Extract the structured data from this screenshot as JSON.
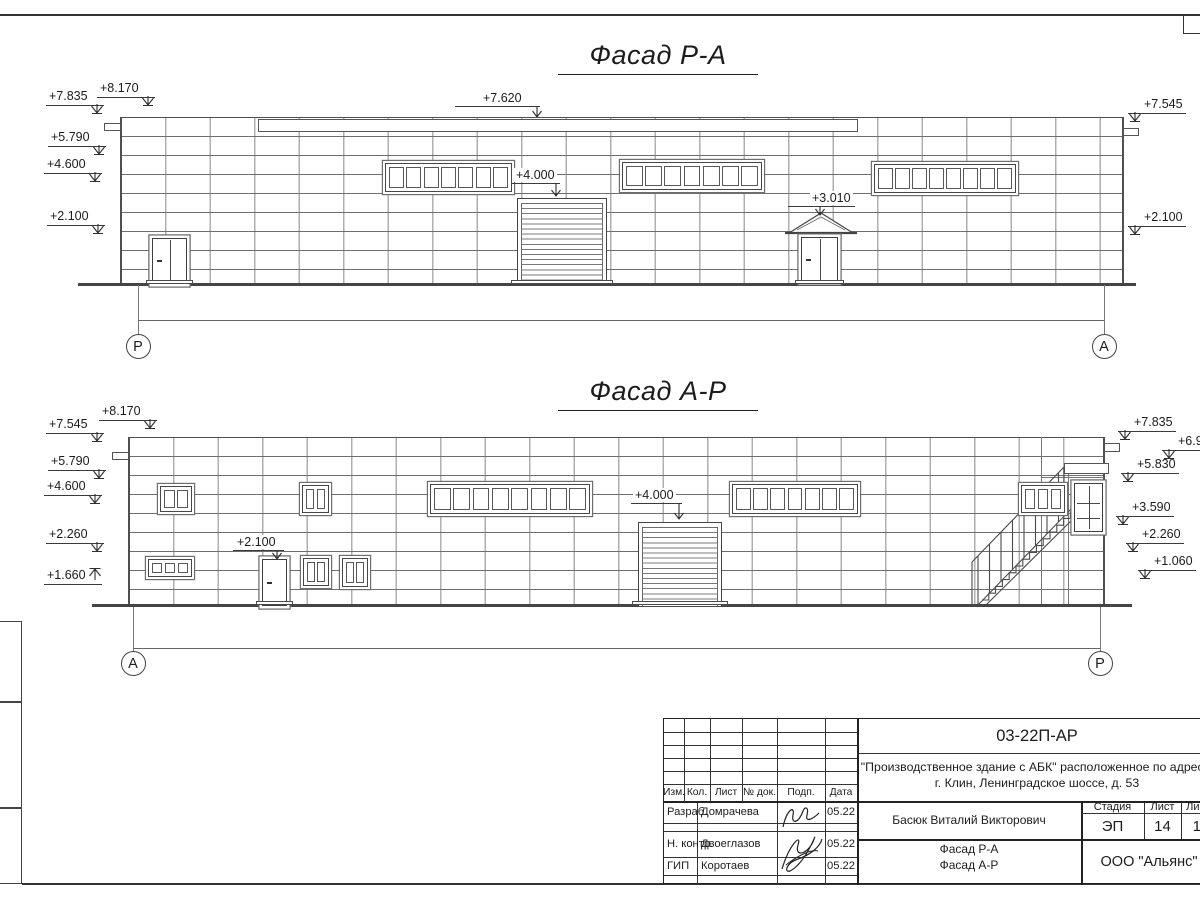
{
  "facade1": {
    "title": "Фасад Р-А",
    "ground_y": 283,
    "axis": {
      "left": "Р",
      "right": "А",
      "lx": 138,
      "rx": 1104,
      "drop_top": 285,
      "dim_y": 320,
      "circle_y": 334
    },
    "openings": [
      {
        "type": "band",
        "x": 385,
        "y": 163,
        "w": 127,
        "h": 29,
        "panes": 7
      },
      {
        "type": "band",
        "x": 622,
        "y": 162,
        "w": 140,
        "h": 28,
        "panes": 7
      },
      {
        "type": "band",
        "x": 874,
        "y": 164,
        "w": 142,
        "h": 29,
        "panes": 8
      },
      {
        "type": "roller",
        "x": 517,
        "y": 198,
        "w": 90,
        "h": 86
      },
      {
        "type": "door2",
        "x": 152,
        "y": 238,
        "w": 35,
        "h": 46
      },
      {
        "type": "door2",
        "x": 801,
        "y": 237,
        "w": 37,
        "h": 45
      }
    ],
    "marks": [
      {
        "label": "+7.835",
        "x": 46,
        "y": 89,
        "side": "r",
        "dir": "down"
      },
      {
        "label": "+8.170",
        "x": 97,
        "y": 81,
        "side": "r",
        "dir": "down"
      },
      {
        "label": "+5.790",
        "x": 48,
        "y": 130,
        "side": "r",
        "dir": "down"
      },
      {
        "label": "+4.600",
        "x": 44,
        "y": 157,
        "side": "r",
        "dir": "down"
      },
      {
        "label": "+2.100",
        "x": 47,
        "y": 209,
        "side": "r",
        "dir": "down"
      },
      {
        "label": "+7.545",
        "x": 1128,
        "y": 97,
        "side": "l",
        "dir": "down"
      },
      {
        "label": "+2.100",
        "x": 1128,
        "y": 210,
        "side": "l",
        "dir": "down"
      }
    ],
    "labels": [
      {
        "text": "+7.620",
        "x": 481,
        "y": 91,
        "sx1": 455,
        "sx2": 540,
        "ax": 537,
        "ty": 118
      },
      {
        "text": "+4.000",
        "x": 514,
        "y": 168,
        "sx1": 511,
        "sx2": 560,
        "ax": 556,
        "ty": 197
      },
      {
        "text": "+3.010",
        "x": 810,
        "y": 191,
        "sx1": 788,
        "sx2": 855,
        "ax": 820,
        "ty": 212
      }
    ]
  },
  "facade2": {
    "title": "Фасад А-Р",
    "ground_y": 604,
    "axis": {
      "left": "А",
      "right": "Р",
      "lx": 133,
      "rx": 1100,
      "drop_top": 607,
      "dim_y": 648,
      "circle_y": 651
    },
    "openings": [
      {
        "type": "window",
        "x": 160,
        "y": 486,
        "w": 32,
        "h": 26,
        "panes": 2
      },
      {
        "type": "window",
        "x": 302,
        "y": 485,
        "w": 27,
        "h": 28,
        "panes": 2
      },
      {
        "type": "band",
        "x": 430,
        "y": 484,
        "w": 160,
        "h": 30,
        "panes": 8
      },
      {
        "type": "band",
        "x": 732,
        "y": 484,
        "w": 126,
        "h": 30,
        "panes": 7
      },
      {
        "type": "window",
        "x": 148,
        "y": 559,
        "w": 44,
        "h": 18,
        "panes": 3
      },
      {
        "type": "window",
        "x": 303,
        "y": 558,
        "w": 26,
        "h": 28,
        "panes": 2
      },
      {
        "type": "window",
        "x": 342,
        "y": 558,
        "w": 26,
        "h": 29,
        "panes": 2
      },
      {
        "type": "door1",
        "x": 262,
        "y": 559,
        "w": 25,
        "h": 47
      },
      {
        "type": "roller",
        "x": 638,
        "y": 522,
        "w": 84,
        "h": 85
      },
      {
        "type": "window",
        "x": 1021,
        "y": 485,
        "w": 44,
        "h": 28,
        "panes": 3
      },
      {
        "type": "doorg",
        "x": 1074,
        "y": 483,
        "w": 29,
        "h": 49
      }
    ],
    "marks": [
      {
        "label": "+8.170",
        "x": 99,
        "y": 404,
        "side": "r",
        "dir": "down"
      },
      {
        "label": "+7.545",
        "x": 46,
        "y": 417,
        "side": "r",
        "dir": "down"
      },
      {
        "label": "+5.790",
        "x": 48,
        "y": 454,
        "side": "r",
        "dir": "down"
      },
      {
        "label": "+4.600",
        "x": 44,
        "y": 479,
        "side": "r",
        "dir": "down"
      },
      {
        "label": "+2.260",
        "x": 46,
        "y": 527,
        "side": "r",
        "dir": "down"
      },
      {
        "label": "+1.660",
        "x": 44,
        "y": 568,
        "side": "r",
        "dir": "up"
      },
      {
        "label": "+7.835",
        "x": 1118,
        "y": 415,
        "side": "l",
        "dir": "down"
      },
      {
        "label": "+6.97",
        "x": 1162,
        "y": 434,
        "side": "l",
        "dir": "down"
      },
      {
        "label": "+5.830",
        "x": 1121,
        "y": 457,
        "side": "l",
        "dir": "down"
      },
      {
        "label": "+3.590",
        "x": 1116,
        "y": 500,
        "side": "l",
        "dir": "down"
      },
      {
        "label": "+2.260",
        "x": 1126,
        "y": 527,
        "side": "l",
        "dir": "down"
      },
      {
        "label": "+1.060",
        "x": 1138,
        "y": 554,
        "side": "l",
        "dir": "down"
      }
    ],
    "labels": [
      {
        "text": "+4.000",
        "x": 633,
        "y": 488,
        "sx1": 631,
        "sx2": 682,
        "ax": 679,
        "ty": 520
      },
      {
        "text": "+2.100",
        "x": 235,
        "y": 535,
        "sx1": 233,
        "sx2": 284,
        "ax": 277,
        "ty": 557
      }
    ]
  },
  "titleblock": {
    "doc_number": "03-22П-АР",
    "project_line1": "\"Производственное здание с АБК\" расположенное по адресу:",
    "project_line2": "г. Клин, Ленинградское шоссе, д. 53",
    "rev_headers": [
      "Изм.",
      "Кол.",
      "Лист",
      "№ док.",
      "Подп.",
      "Дата"
    ],
    "people": [
      {
        "role": "Разраб.",
        "name": "Домрачева",
        "date": "05.22"
      },
      {
        "role": "Н. контр.",
        "name": "Двоеглазов",
        "date": "05.22"
      },
      {
        "role": "ГИП",
        "name": "Коротаев",
        "date": "05.22"
      }
    ],
    "author": "Басюк Виталий Викторович",
    "stage_label": "Стадия",
    "sheet_label": "Лист",
    "sheets_label": "Листов",
    "stage": "ЭП",
    "sheet": "14",
    "sheets": "19",
    "drawing_title_line1": "Фасад Р-А",
    "drawing_title_line2": "Фасад А-Р",
    "company": "ООО \"Альянс\""
  }
}
